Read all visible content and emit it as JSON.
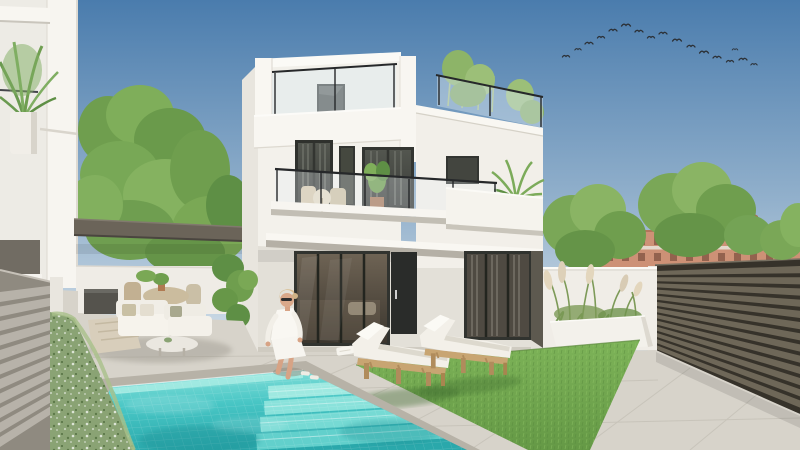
{
  "scene": {
    "title": "Modern three-storey white villa with private pool",
    "description": "Daytime architectural exterior render: white villa with roof terrace and glass railings, balcony with bistro set, pergola lounge with white sofas, turquoise mosaic pool with steps, woman seated on the pool edge, two wooden sun loungers on a lawn strip, planter with ornamental grasses, slatted privacy fences, neighbouring villa, green trees, distant terracotta apartment buildings and a flock of birds."
  },
  "colors": {
    "sky_top": "#4a7cad",
    "sky_mid": "#93b1cc",
    "sky_horizon": "#e7edf2",
    "villa_bright": "#f9f7f2",
    "villa_white": "#f2f0ea",
    "villa_shade": "#e8e5de",
    "slab_shadow": "#b5b0a6",
    "window_frame": "#2f312d",
    "window_glass": "#43453f",
    "ground_glass": "#584f44",
    "curtain": "#6b6e66",
    "railing_metal": "#26282a",
    "railing_glass": "#d6e4ee",
    "pergola": "#6b6459",
    "tree_green": "#79a756",
    "tree_green_dark": "#5e8f45",
    "tree_green_light": "#8ab464",
    "hedge": "#8aa374",
    "pool_light": "#8fe4dd",
    "pool_mid": "#48c6c5",
    "pool_deep": "#2aa8ab",
    "pool_step": "#9fe9e1",
    "coping": "#b7b2a7",
    "paving": "#d7d3ca",
    "paving_joint": "#c2beb4",
    "lawn_light": "#7db358",
    "lawn_dark": "#659946",
    "wood": "#c8a572",
    "wood_dark": "#b08c5c",
    "cushion": "#f3f0e9",
    "fence_right": "#36322a",
    "fence_right_slat": "#6e6758",
    "fence_left": "#8f8a80",
    "fence_left_slat": "#b7b2a9",
    "bg_building": "#cd9176",
    "bg_building_roof": "#a96b52",
    "planter": "#f3f1eb",
    "plume": "#e3d6bd",
    "skin": "#d7a385",
    "hair": "#d8bd90",
    "outfit": "#f9f7f2",
    "bird": "#2c3137"
  },
  "birds": {
    "count": 17,
    "positions": [
      [
        566,
        57,
        0.9
      ],
      [
        578,
        50,
        0.8
      ],
      [
        589,
        44,
        1
      ],
      [
        601,
        38,
        0.9
      ],
      [
        613,
        31,
        1
      ],
      [
        626,
        26,
        1.1
      ],
      [
        639,
        32,
        1
      ],
      [
        651,
        38,
        0.9
      ],
      [
        663,
        34,
        1
      ],
      [
        677,
        41,
        1.1
      ],
      [
        691,
        47,
        1
      ],
      [
        704,
        53,
        1.1
      ],
      [
        717,
        58,
        1
      ],
      [
        730,
        62,
        0.9
      ],
      [
        743,
        60,
        1
      ],
      [
        754,
        65,
        0.8
      ],
      [
        735,
        50,
        0.7
      ]
    ]
  },
  "objects": [
    {
      "name": "main-villa",
      "label": "three-storey white villa"
    },
    {
      "name": "penthouse",
      "label": "set-back top floor with dark window"
    },
    {
      "name": "roof-terrace-railing",
      "label": "glass and black-steel roof railings"
    },
    {
      "name": "balcony",
      "label": "first-floor balcony with bistro set and plants"
    },
    {
      "name": "pergola-lounge",
      "label": "pergola with white outdoor sofa set"
    },
    {
      "name": "swimming-pool",
      "label": "turquoise mosaic pool with corner steps"
    },
    {
      "name": "woman-by-pool",
      "label": "woman in white seated on pool edge"
    },
    {
      "name": "sun-loungers",
      "label": "two wooden loungers with white cushions"
    },
    {
      "name": "lawn",
      "label": "artificial grass strip"
    },
    {
      "name": "planter",
      "label": "white planter with ornamental grasses"
    },
    {
      "name": "privacy-fence-right",
      "label": "dark horizontal-slat fence"
    },
    {
      "name": "privacy-fence-left",
      "label": "light horizontal-slat fence"
    },
    {
      "name": "flowering-hedge",
      "label": "low hedge with white blossoms"
    },
    {
      "name": "neighbor-villa",
      "label": "white neighbouring villa with palm"
    },
    {
      "name": "background-apartments",
      "label": "distant terracotta apartment blocks"
    },
    {
      "name": "trees",
      "label": "green garden trees"
    },
    {
      "name": "bird-flock",
      "label": "flock of birds in the sky"
    }
  ]
}
